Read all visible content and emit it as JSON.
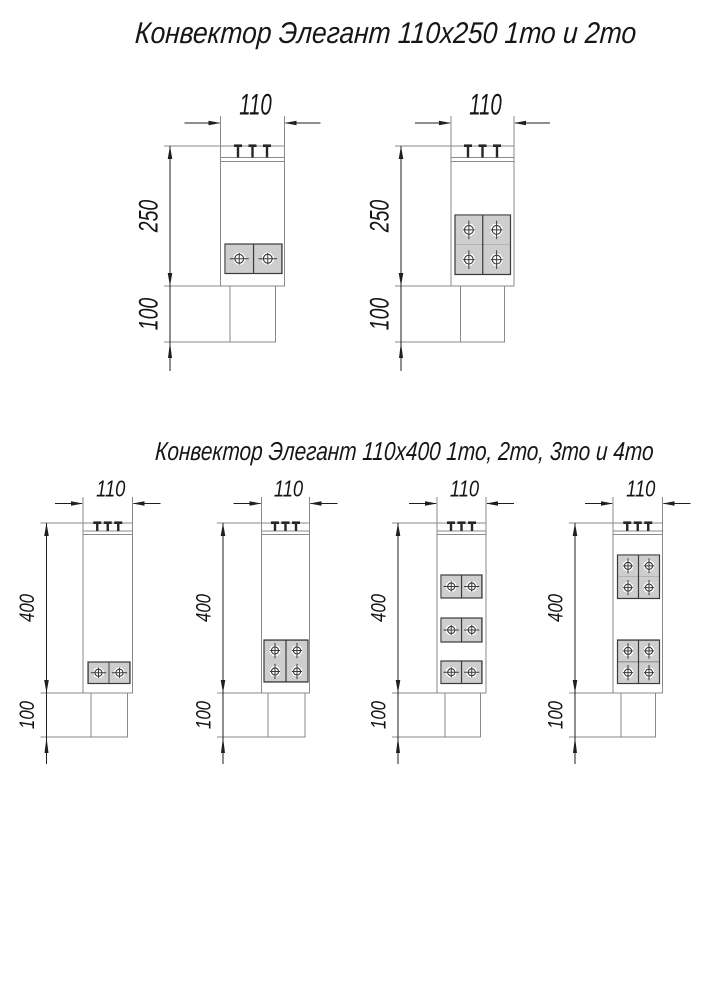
{
  "page": {
    "background": "#ffffff",
    "kind": "technical drawing, convector sections"
  },
  "colors": {
    "outline": "#8a8a8a",
    "dimension": "#1f1f1f",
    "text": "#141414",
    "element_frame": "#3a3a3a",
    "hatch": "#7d7d7d",
    "white": "#ffffff"
  },
  "sections": [
    {
      "title": "Конвектор Элегант 110x250 1то и 2то",
      "drawings": [
        {
          "variant": "1то",
          "width_label": "110",
          "height_label": "250",
          "base_label": "100",
          "geom": {
            "size": "lg",
            "dimX": 170,
            "dimY": 123,
            "extTop": 116,
            "bodyL": 220.5,
            "bodyR": 284.5,
            "topY": 146,
            "botY": 286,
            "baseL": 230,
            "baseR": 275.5,
            "baseBot": 342
          },
          "exchangers": [
            {
              "x": 225,
              "y": 244,
              "w": 57,
              "h": 29.5,
              "rows": 1
            }
          ]
        },
        {
          "variant": "2то",
          "width_label": "110",
          "height_label": "250",
          "base_label": "100",
          "geom": {
            "size": "lg",
            "dimX": 401,
            "dimY": 123,
            "extTop": 116,
            "bodyL": 451,
            "bodyR": 514,
            "topY": 146,
            "botY": 286,
            "baseL": 460.5,
            "baseR": 504.5,
            "baseBot": 342
          },
          "exchangers": [
            {
              "x": 455,
              "y": 215,
              "w": 55.5,
              "h": 59.5,
              "rows": 2
            }
          ]
        }
      ]
    },
    {
      "title": "Конвектор Элегант 110x400 1то, 2то, 3то и 4то",
      "drawings": [
        {
          "variant": "1то",
          "width_label": "110",
          "height_label": "400",
          "base_label": "100",
          "geom": {
            "size": "sm",
            "dimX": 46.5,
            "dimY": 503.5,
            "extTop": 497,
            "bodyL": 83,
            "bodyR": 132.5,
            "topY": 523,
            "botY": 693,
            "baseL": 91,
            "baseR": 127.5,
            "baseBot": 737
          },
          "exchangers": [
            {
              "x": 88,
              "y": 662,
              "w": 42,
              "h": 21.5,
              "rows": 1
            }
          ]
        },
        {
          "variant": "2то",
          "width_label": "110",
          "height_label": "400",
          "base_label": "100",
          "geom": {
            "size": "sm",
            "dimX": 223,
            "dimY": 503.5,
            "extTop": 497,
            "bodyL": 261.5,
            "bodyR": 309.5,
            "topY": 523,
            "botY": 693,
            "baseL": 268,
            "baseR": 305,
            "baseBot": 737
          },
          "exchangers": [
            {
              "x": 264,
              "y": 640,
              "w": 44,
              "h": 42,
              "rows": 2
            }
          ]
        },
        {
          "variant": "3то",
          "width_label": "110",
          "height_label": "400",
          "base_label": "100",
          "geom": {
            "size": "sm",
            "dimX": 398,
            "dimY": 503.5,
            "extTop": 497,
            "bodyL": 437,
            "bodyR": 486,
            "topY": 523,
            "botY": 693,
            "baseL": 445,
            "baseR": 480.5,
            "baseBot": 737
          },
          "exchangers": [
            {
              "x": 441,
              "y": 575,
              "w": 41,
              "h": 23,
              "rows": 1
            },
            {
              "x": 441,
              "y": 618,
              "w": 41,
              "h": 24,
              "rows": 1
            },
            {
              "x": 441,
              "y": 661,
              "w": 41,
              "h": 22.5,
              "rows": 1
            }
          ]
        },
        {
          "variant": "4то",
          "width_label": "110",
          "height_label": "400",
          "base_label": "100",
          "geom": {
            "size": "sm",
            "dimX": 575,
            "dimY": 503.5,
            "extTop": 497,
            "bodyL": 613,
            "bodyR": 662.5,
            "topY": 523,
            "botY": 693,
            "baseL": 621,
            "baseR": 655.5,
            "baseBot": 737
          },
          "exchangers": [
            {
              "x": 617.5,
              "y": 555,
              "w": 42,
              "h": 43.5,
              "rows": 2
            },
            {
              "x": 617.5,
              "y": 640,
              "w": 42,
              "h": 43.5,
              "rows": 2
            }
          ]
        }
      ]
    }
  ]
}
